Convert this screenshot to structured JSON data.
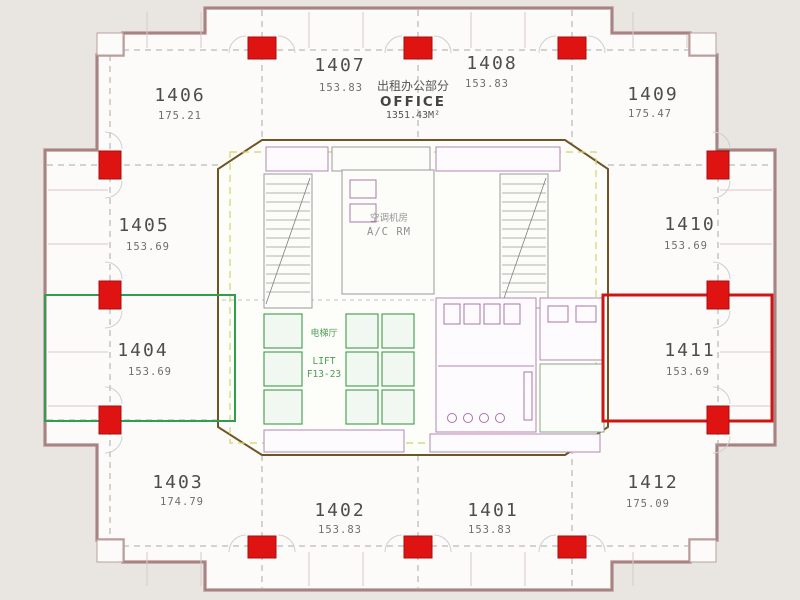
{
  "plan": {
    "office_block": {
      "cn": "出租办公部分",
      "en": "OFFICE",
      "area": "1351.43M²"
    },
    "core": {
      "ac_room_cn": "空调机房",
      "ac_room_en": "A/C RM",
      "lift_cn": "电梯厅",
      "lift_en": "LIFT",
      "lift_range": "F13-23"
    },
    "units": [
      {
        "number": "1401",
        "area": "153.83"
      },
      {
        "number": "1402",
        "area": "153.83"
      },
      {
        "number": "1403",
        "area": "174.79"
      },
      {
        "number": "1404",
        "area": "153.69",
        "highlight": "green"
      },
      {
        "number": "1405",
        "area": "153.69"
      },
      {
        "number": "1406",
        "area": "175.21"
      },
      {
        "number": "1407",
        "area": "153.83"
      },
      {
        "number": "1408",
        "area": "153.83"
      },
      {
        "number": "1409",
        "area": "175.47"
      },
      {
        "number": "1410",
        "area": "153.69"
      },
      {
        "number": "1411",
        "area": "153.69",
        "highlight": "red"
      },
      {
        "number": "1412",
        "area": "175.09"
      }
    ]
  },
  "colors": {
    "column_red": "#e01313",
    "highlight_green": "#2f9e4e",
    "highlight_red": "#cf1414",
    "facade": "#bd9a9a",
    "facade_dark": "#8f6f6f",
    "core_outline": "#6f5524"
  }
}
